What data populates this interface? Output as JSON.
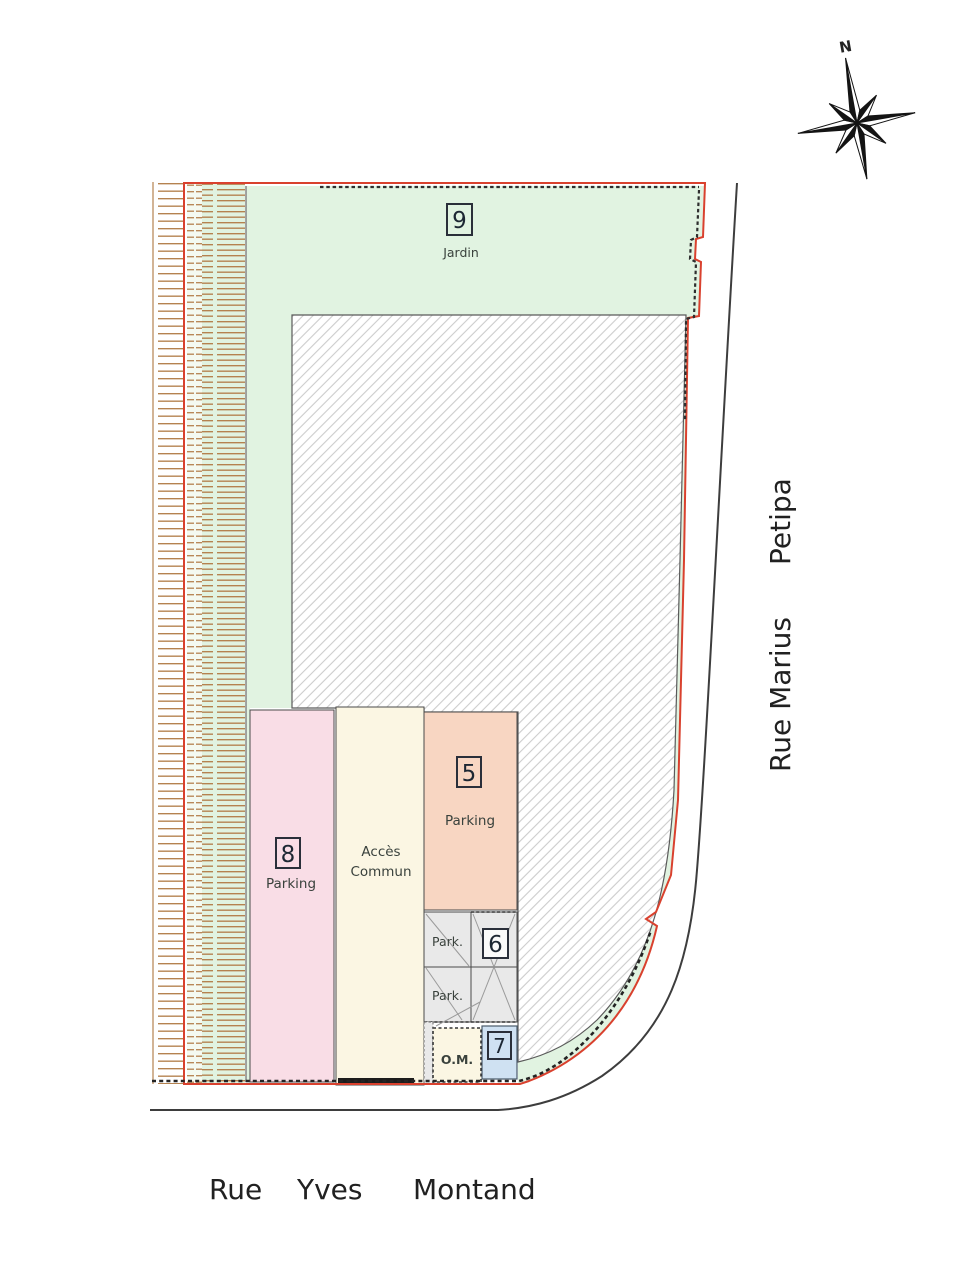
{
  "plan": {
    "compass": {
      "north": "N"
    },
    "streets": {
      "vertical_name_part1": "Rue Marius",
      "vertical_name_part2": "Petipa",
      "horizontal_word1": "Rue",
      "horizontal_word2": "Yves",
      "horizontal_word3": "Montand"
    },
    "zones": {
      "garden": {
        "number": "9",
        "label": "Jardin"
      },
      "parking8": {
        "number": "8",
        "label": "Parking"
      },
      "acces_commun": {
        "line1": "Accès",
        "line2": "Commun"
      },
      "parking5": {
        "number": "5",
        "label": "Parking"
      },
      "zone6": {
        "number": "6",
        "park_label_top": "Park.",
        "park_label_bottom": "Park."
      },
      "om": {
        "label": "O.M."
      },
      "zone7": {
        "number": "7"
      }
    }
  },
  "colors": {
    "boundary_red": "#d9412e",
    "garden_green": "#e1f3e1",
    "ladder_rung_brown": "#b5824f",
    "ladder_white_bg": "#ffffff",
    "ladder_green_bg": "#e1f3e1",
    "hatch_line_gray": "#cccccc",
    "parking8_pink": "#f9dde6",
    "acces_cream": "#fbf6e3",
    "parking5_salmon": "#f8d6c2",
    "zone6_gray": "#e9e9e9",
    "zone7_blue": "#cfe1f2",
    "street_line": "#3d3d3d"
  }
}
